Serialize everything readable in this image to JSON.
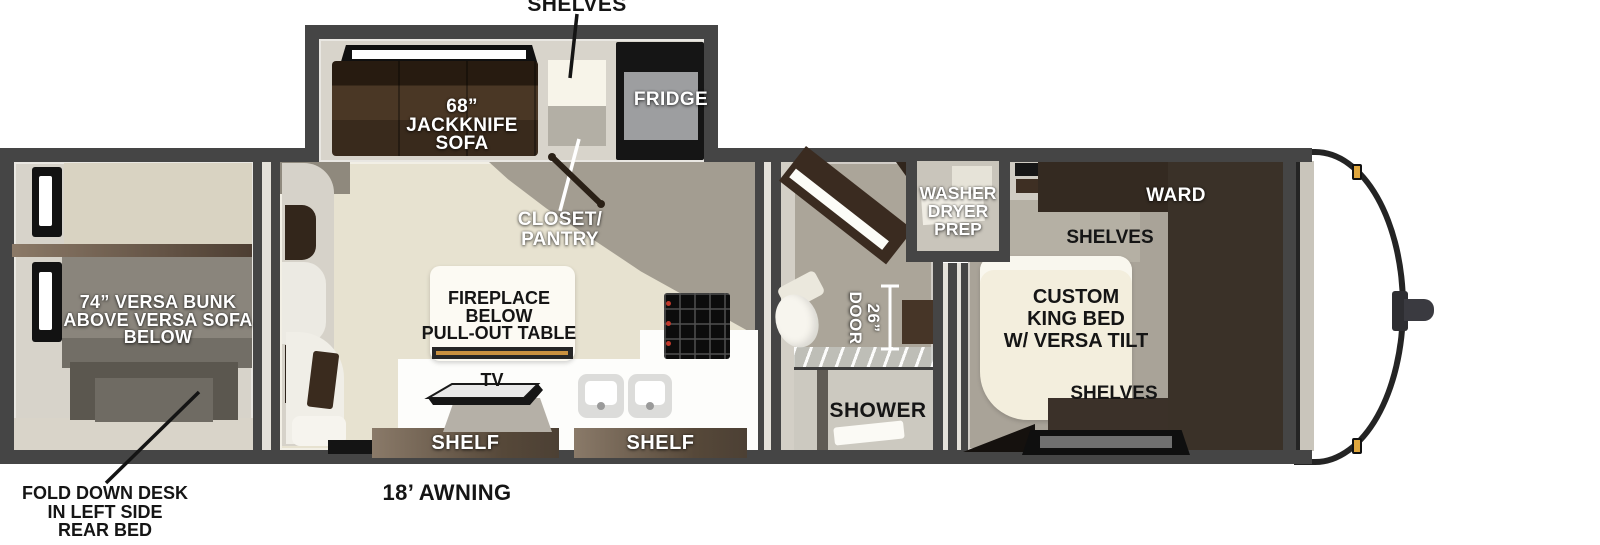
{
  "title": "Travel trailer floor plan diagram",
  "colors": {
    "wall": "#454545",
    "floor_cream": "#e7e2d0",
    "floor_tan": "#a39d91",
    "furniture_brown": "#3a2b1d",
    "shelf_bar_brown": "#5d4c3d",
    "bed_cream": "#f3eedd",
    "label_black": "#151515",
    "label_white": "#ffffff",
    "marker_amber": "#dfa63d"
  },
  "rooms": {
    "slideout": {
      "shelves_callout": "SHELVES",
      "sofa": [
        "68”",
        "JACKKNIFE",
        "SOFA"
      ],
      "fridge": "FRIDGE"
    },
    "rear_bedroom": {
      "bunk": [
        "74” VERSA BUNK",
        "ABOVE VERSA SOFA",
        "BELOW"
      ],
      "desk_note": [
        "FOLD DOWN DESK",
        "IN LEFT SIDE",
        "REAR BED"
      ]
    },
    "living": {
      "closet": [
        "CLOSET/",
        "PANTRY"
      ],
      "fireplace": [
        "FIREPLACE",
        "BELOW",
        "PULL-OUT TABLE"
      ],
      "tv": "TV",
      "shelf_left": "SHELF",
      "shelf_right": "SHELF"
    },
    "bathroom": {
      "washer": [
        "WASHER",
        "DRYER",
        "PREP"
      ],
      "door": [
        "26”",
        "DOOR"
      ],
      "shower": "SHOWER"
    },
    "bedroom": {
      "ward": "WARD",
      "shelves_top": "SHELVES",
      "bed": [
        "CUSTOM",
        "KING BED",
        "W/ VERSA TILT"
      ],
      "shelves_bottom": "SHELVES"
    },
    "exterior": {
      "awning": "18’ AWNING"
    }
  }
}
